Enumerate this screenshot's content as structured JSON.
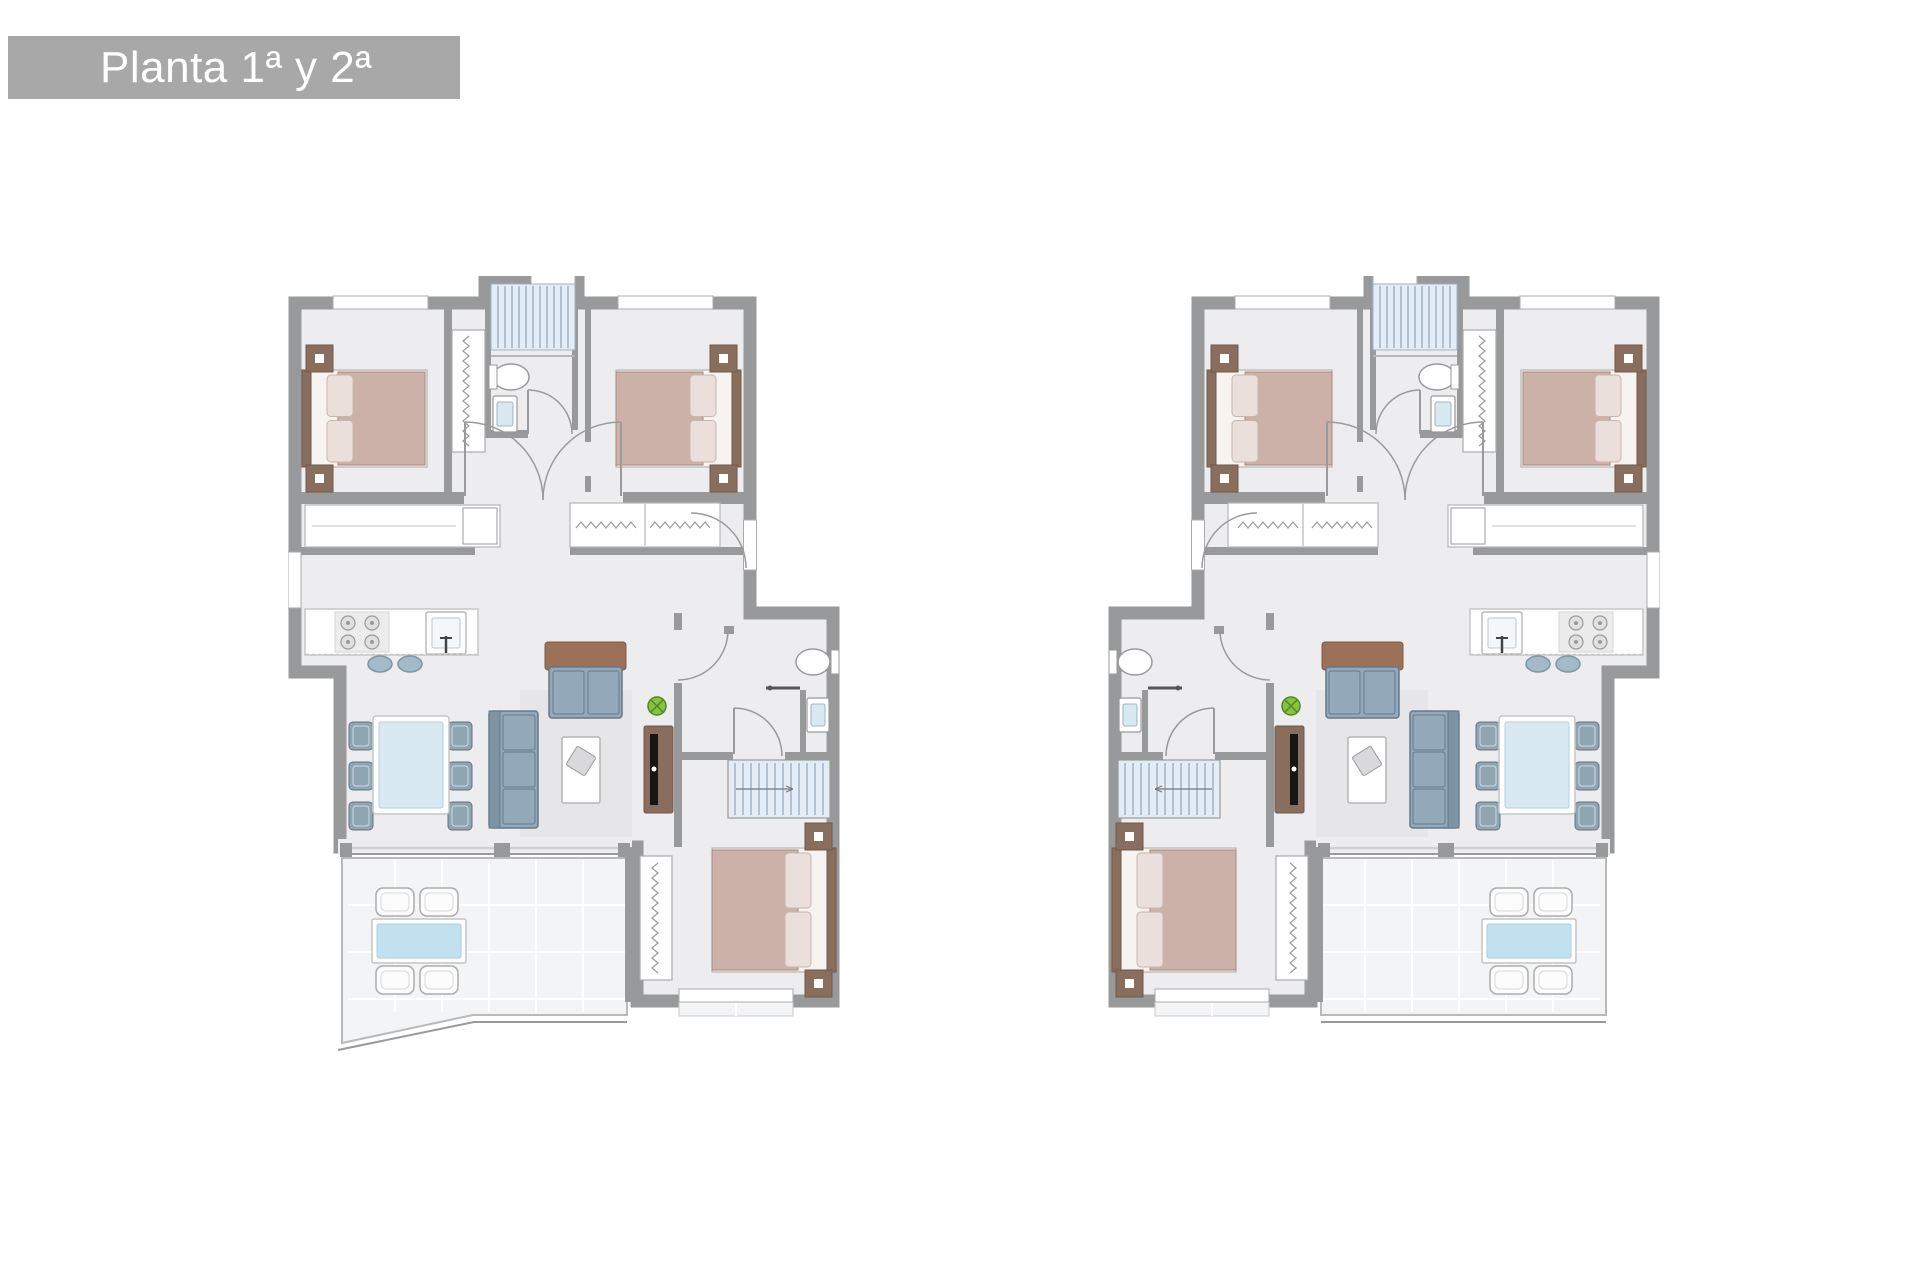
{
  "header": {
    "title": "Planta 1ª y 2ª"
  },
  "palette": {
    "background": "#ffffff",
    "title_bar": "#a8a8a8",
    "title_text": "#ffffff",
    "wall": "#98999b",
    "floor": "#ededef",
    "terrace": "#f3f4f6",
    "tile_line": "#ffffff",
    "wood": "#8a6e5d",
    "wood_light": "#9b7258",
    "bed_blanket": "#ccb1a9",
    "bed_pillow": "#eadfdb",
    "bed_base": "#f7f3f0",
    "sofa": "#93a9b9",
    "sofa_edge": "#64798a",
    "sofa_back": "#7e93a3",
    "chair": "#8fa5b2",
    "table_glass": "#d9e9f2",
    "outdoor_glass": "#c2e1ee",
    "stairs_fill": "#e4edf5",
    "stairs_line": "#9fb4c6",
    "plant": "#85c440",
    "plant_dark": "#54881f",
    "tv": "#161616",
    "line": "#9a9a9a",
    "light_line": "#c6c6c6",
    "rug": "#e6e6e9",
    "stool": "#a3bac8",
    "stool_edge": "#7b96a6"
  },
  "plans": [
    {
      "id": "left-unit",
      "name": "apartment-plan-left",
      "mirrored": false,
      "terrace_corner": "diagonal"
    },
    {
      "id": "right-unit",
      "name": "apartment-plan-right",
      "mirrored": true,
      "terrace_corner": "straight"
    }
  ],
  "element_names": [
    "double-bed",
    "closet",
    "hall-wardrobe",
    "stairs",
    "toilet",
    "wash-basin",
    "shower-head",
    "kitchen-counter",
    "stove",
    "kitchen-sink",
    "bar-stools",
    "dining-table",
    "dining-chair",
    "sofa",
    "coffee-table",
    "rug",
    "tv-console",
    "plant",
    "terrace",
    "outdoor-table",
    "outdoor-chair",
    "door-arc",
    "window",
    "glass-wall",
    "balcony-strip"
  ]
}
